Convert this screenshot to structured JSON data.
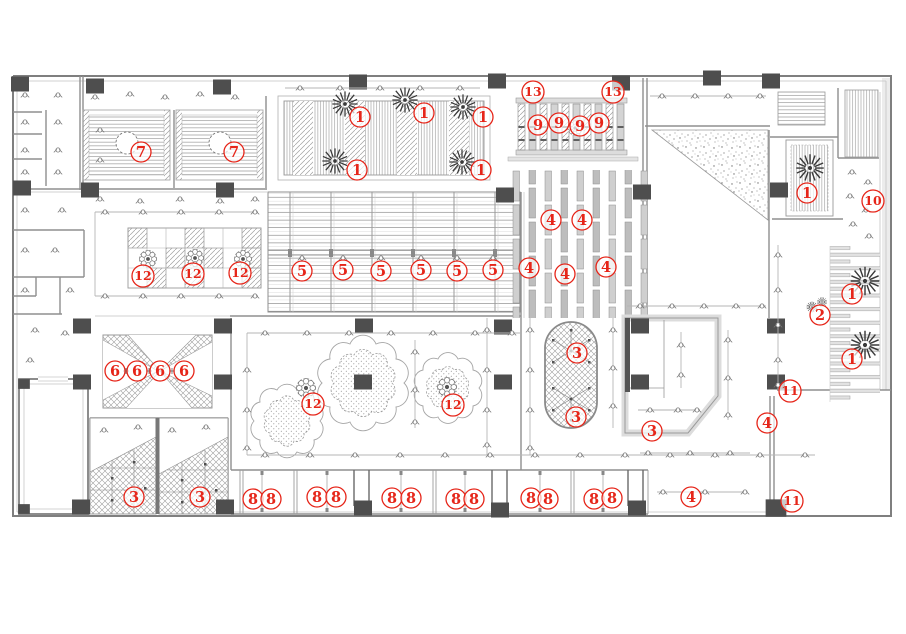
{
  "meta": {
    "title": "ceiling-plan-drawing",
    "width": 906,
    "height": 634
  },
  "palette": {
    "annotation_red": "#e62519",
    "wall_gray": "#7f7f7f",
    "column_gray": "#4e4e4e",
    "hatch_gray": "#9a9a9a",
    "light_gray": "#d8d8d8"
  },
  "annotations": [
    {
      "label": "7",
      "x": 141,
      "y": 152
    },
    {
      "label": "7",
      "x": 234,
      "y": 152
    },
    {
      "label": "1",
      "x": 360,
      "y": 117
    },
    {
      "label": "1",
      "x": 424,
      "y": 113
    },
    {
      "label": "1",
      "x": 483,
      "y": 117
    },
    {
      "label": "1",
      "x": 357,
      "y": 170
    },
    {
      "label": "1",
      "x": 481,
      "y": 170
    },
    {
      "label": "13",
      "x": 533,
      "y": 92
    },
    {
      "label": "13",
      "x": 613,
      "y": 92
    },
    {
      "label": "9",
      "x": 538,
      "y": 125
    },
    {
      "label": "9",
      "x": 559,
      "y": 123
    },
    {
      "label": "9",
      "x": 580,
      "y": 126
    },
    {
      "label": "9",
      "x": 599,
      "y": 123
    },
    {
      "label": "4",
      "x": 551,
      "y": 220
    },
    {
      "label": "4",
      "x": 582,
      "y": 220
    },
    {
      "label": "4",
      "x": 529,
      "y": 268
    },
    {
      "label": "4",
      "x": 565,
      "y": 274
    },
    {
      "label": "4",
      "x": 606,
      "y": 267
    },
    {
      "label": "5",
      "x": 302,
      "y": 271
    },
    {
      "label": "5",
      "x": 343,
      "y": 270
    },
    {
      "label": "5",
      "x": 381,
      "y": 271
    },
    {
      "label": "5",
      "x": 421,
      "y": 270
    },
    {
      "label": "5",
      "x": 457,
      "y": 271
    },
    {
      "label": "5",
      "x": 493,
      "y": 270
    },
    {
      "label": "12",
      "x": 143,
      "y": 276
    },
    {
      "label": "12",
      "x": 193,
      "y": 274
    },
    {
      "label": "12",
      "x": 240,
      "y": 273
    },
    {
      "label": "6",
      "x": 115,
      "y": 371
    },
    {
      "label": "6",
      "x": 137,
      "y": 371
    },
    {
      "label": "6",
      "x": 160,
      "y": 371
    },
    {
      "label": "6",
      "x": 184,
      "y": 371
    },
    {
      "label": "12",
      "x": 313,
      "y": 404
    },
    {
      "label": "12",
      "x": 453,
      "y": 405
    },
    {
      "label": "3",
      "x": 577,
      "y": 353
    },
    {
      "label": "3",
      "x": 576,
      "y": 417
    },
    {
      "label": "3",
      "x": 652,
      "y": 431
    },
    {
      "label": "3",
      "x": 134,
      "y": 497
    },
    {
      "label": "3",
      "x": 200,
      "y": 497
    },
    {
      "label": "8",
      "x": 253,
      "y": 499
    },
    {
      "label": "8",
      "x": 271,
      "y": 499
    },
    {
      "label": "8",
      "x": 317,
      "y": 497
    },
    {
      "label": "8",
      "x": 336,
      "y": 497
    },
    {
      "label": "8",
      "x": 392,
      "y": 498
    },
    {
      "label": "8",
      "x": 411,
      "y": 498
    },
    {
      "label": "8",
      "x": 456,
      "y": 499
    },
    {
      "label": "8",
      "x": 474,
      "y": 499
    },
    {
      "label": "8",
      "x": 531,
      "y": 498
    },
    {
      "label": "8",
      "x": 548,
      "y": 499
    },
    {
      "label": "8",
      "x": 594,
      "y": 499
    },
    {
      "label": "8",
      "x": 612,
      "y": 498
    },
    {
      "label": "4",
      "x": 691,
      "y": 497
    },
    {
      "label": "4",
      "x": 767,
      "y": 423
    },
    {
      "label": "11",
      "x": 790,
      "y": 391
    },
    {
      "label": "11",
      "x": 792,
      "y": 501
    },
    {
      "label": "1",
      "x": 852,
      "y": 294
    },
    {
      "label": "1",
      "x": 852,
      "y": 359
    },
    {
      "label": "2",
      "x": 820,
      "y": 315
    },
    {
      "label": "1",
      "x": 807,
      "y": 193
    },
    {
      "label": "10",
      "x": 873,
      "y": 201
    }
  ]
}
